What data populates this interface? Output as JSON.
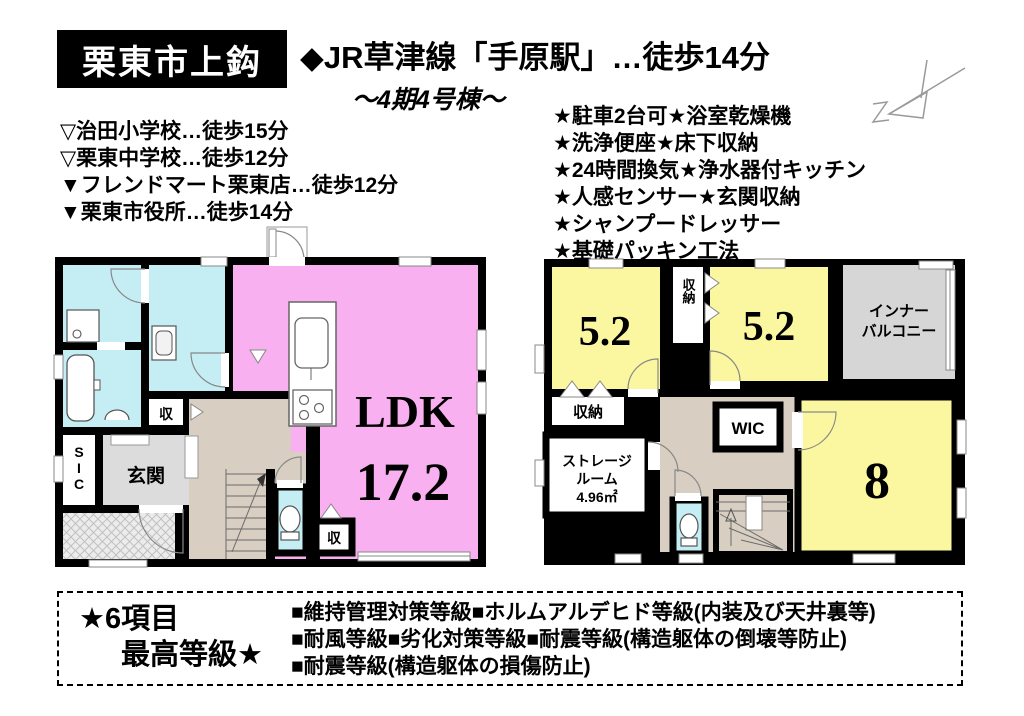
{
  "header": {
    "location_badge": "栗東市上鈎",
    "train_line": "◆JR草津線「手原駅」…徒歩14分",
    "building": "～4期4号棟～"
  },
  "access": {
    "items": [
      "▽治田小学校…徒歩15分",
      "▽栗東中学校…徒歩12分",
      "▼フレンドマート栗東店…徒歩12分",
      "▼栗東市役所…徒歩14分"
    ]
  },
  "features": {
    "items": [
      "★駐車2台可★浴室乾燥機",
      "★洗浄便座★床下収納",
      "★24時間換気★浄水器付キッチン",
      "★人感センサー★玄関収納",
      "★シャンプードレッサー",
      "★基礎パッキン工法"
    ]
  },
  "floor1": {
    "ldk_label": "LDK",
    "ldk_size": "17.2",
    "entrance": "玄関",
    "shoe_closet": "SIC",
    "closet_a": "収",
    "closet_b": "収"
  },
  "floor2": {
    "room_a_size": "5.2",
    "room_b_size": "5.2",
    "room_c_size": "8",
    "closet_top": "収納",
    "closet_left": "収納",
    "balcony_line1": "インナー",
    "balcony_line2": "バルコニー",
    "storage_line1": "ストレージ",
    "storage_line2": "ルーム",
    "storage_area": "4.96㎡",
    "wic": "WIC"
  },
  "ratings": {
    "headline_line1": "★6項目",
    "headline_line2": "最高等級★",
    "lines": [
      "■維持管理対策等級■ホルムアルデヒド等級(内装及び天井裏等)",
      "■耐風等級■劣化対策等級■耐震等級(構造躯体の倒壊等防止)",
      "■耐震等級(構造躯体の損傷防止)"
    ]
  },
  "colors": {
    "room_pink": "#f8b0f0",
    "room_yellow": "#fbf7a0",
    "room_cyan": "#c5eef4",
    "hall_beige": "#d8cec2",
    "gray_area": "#d6d6d6",
    "entrance_gray": "#dcdcdc",
    "wall_black": "#000000"
  }
}
